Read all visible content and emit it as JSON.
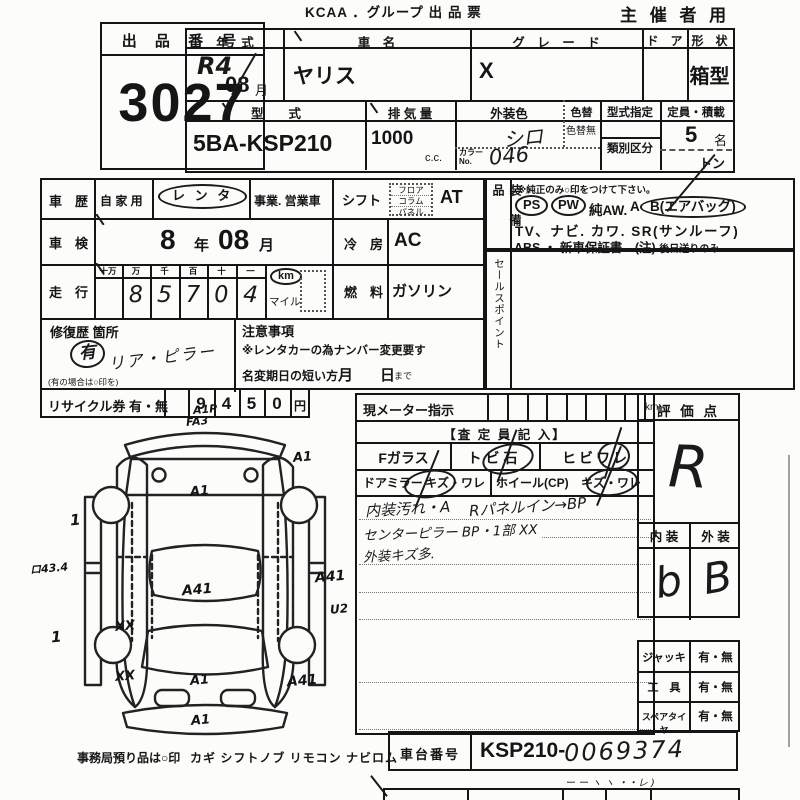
{
  "header": {
    "title": "KCAA ．グループ 出 品 票",
    "audience": "主 催 者 用"
  },
  "lot": {
    "label": "出 品 番 号",
    "number": "3027"
  },
  "spec": {
    "year_label": "年　式",
    "year_value": "R4",
    "month_value": "08",
    "month_unit": "月",
    "car_label": "車　名",
    "car_value": "ヤリス",
    "grade_label": "グ　レ　ー　ド",
    "grade_value": "X",
    "door_label": "ド　ア",
    "shape_label": "形　状",
    "shape_value": "箱型",
    "model_label": "型　　式",
    "model_value": "5BA-KSP210",
    "disp_label": "排 気 量",
    "disp_value": "1000",
    "disp_unit": "c.c.",
    "color_label": "外装色",
    "color_value": "シロ",
    "repaint_label": "色替",
    "repaint_none": "色替無",
    "color_no_label1": "カラー",
    "color_no_label2": "No.",
    "color_no_value": "046",
    "approval_label": "型式指定",
    "class_label": "類別区分",
    "cap_label": "定員・積載",
    "cap_value": "5",
    "cap_unit": "名",
    "load_unit": "トン"
  },
  "usage": {
    "label": "車　歴",
    "private": "自 家 用",
    "rental": "レ ン タ",
    "business": "事業. 営業車"
  },
  "inspection": {
    "label": "車　検",
    "year": "8",
    "year_unit": "年",
    "month": "08",
    "month_unit": "月"
  },
  "mileage": {
    "label": "走　行",
    "cols": [
      "十万",
      "万",
      "千",
      "百",
      "十",
      "一"
    ],
    "digits": [
      "",
      "8",
      "5",
      "7",
      "0",
      "4"
    ],
    "km": "km",
    "mile": "マイル"
  },
  "shift": {
    "label": "シフト",
    "opts": [
      "フロア",
      "コラム",
      "パネル"
    ],
    "value": "AT"
  },
  "cooling": {
    "label": "冷　房",
    "value": "AC"
  },
  "fuel": {
    "label": "燃　料",
    "value": "ガソリン"
  },
  "repair": {
    "label": "修復歴 箇所",
    "flag": "有",
    "detail": "リア・ピラー",
    "hint": "(有の場合は○印を)"
  },
  "caution": {
    "label": "注意事項",
    "line1": "※レンタカーの為ナンバー変更要す",
    "line2": "名変期日の短い方",
    "month": "月",
    "day": "日",
    "suffix": "まで"
  },
  "recycle": {
    "label": "リサイクル券 有・無",
    "digits": [
      "9",
      "4",
      "5",
      "0"
    ],
    "unit": "円"
  },
  "equipment": {
    "label": "装 備 品",
    "note": "※純正のみ○印をつけて下さい。",
    "ps": "PS",
    "pw": "PW",
    "aw": "純AW.",
    "ab_a": "A",
    "ab_b": "B(エアバッグ)",
    "line2": "TV、ナビ. カワ. SR(サンルーフ)",
    "line3a": "ABS ・ 新車保証書←(注)",
    "line3b": "後日送りのみ"
  },
  "sales": {
    "label": "セールスポイント"
  },
  "meter": {
    "label": "現メーター指示",
    "unit": "km"
  },
  "inspector": {
    "header": "【査 定 員 記 入】",
    "f_glass": "Fガラス",
    "stone": "トビ石",
    "crack": "ヒビワレ",
    "mirror": "ドアミラー",
    "damage1": "キズ・ワレ",
    "wheel": "ホイール(CP)",
    "damage2": "キズ・ワレ",
    "note1a": "内装汚れ・A",
    "note1b": "Rパネルイン→BP",
    "note2": "センターピラー BP・1部 XX",
    "note3": "外装キズ多."
  },
  "rating": {
    "label": "評 価 点",
    "score": "R",
    "interior_label": "内 装",
    "exterior_label": "外 装",
    "interior": "b",
    "exterior": "B"
  },
  "accessories": {
    "jack_label": "ジャッキ",
    "jack_value": "有・無",
    "tool_label": "工　具",
    "tool_value": "有・無",
    "spare_label": "スペアタイヤ",
    "spare_value": "有・無"
  },
  "chassis": {
    "label": "車台番号",
    "prefix": "KSP210-",
    "number": "0069374",
    "scribble": "ー ー ヽ ヽ ・・レ )"
  },
  "office": {
    "note": "事務局預り品は○印",
    "items": "カギ シフトノブ リモコン ナビロム"
  },
  "diagram": {
    "annotations": [
      "A1P",
      "FA3",
      "A1",
      "A1",
      "1",
      "ロ43.4",
      "A41",
      "A41",
      "XX",
      "U2",
      "1",
      "XX",
      "A1",
      "A41",
      "A1"
    ]
  }
}
